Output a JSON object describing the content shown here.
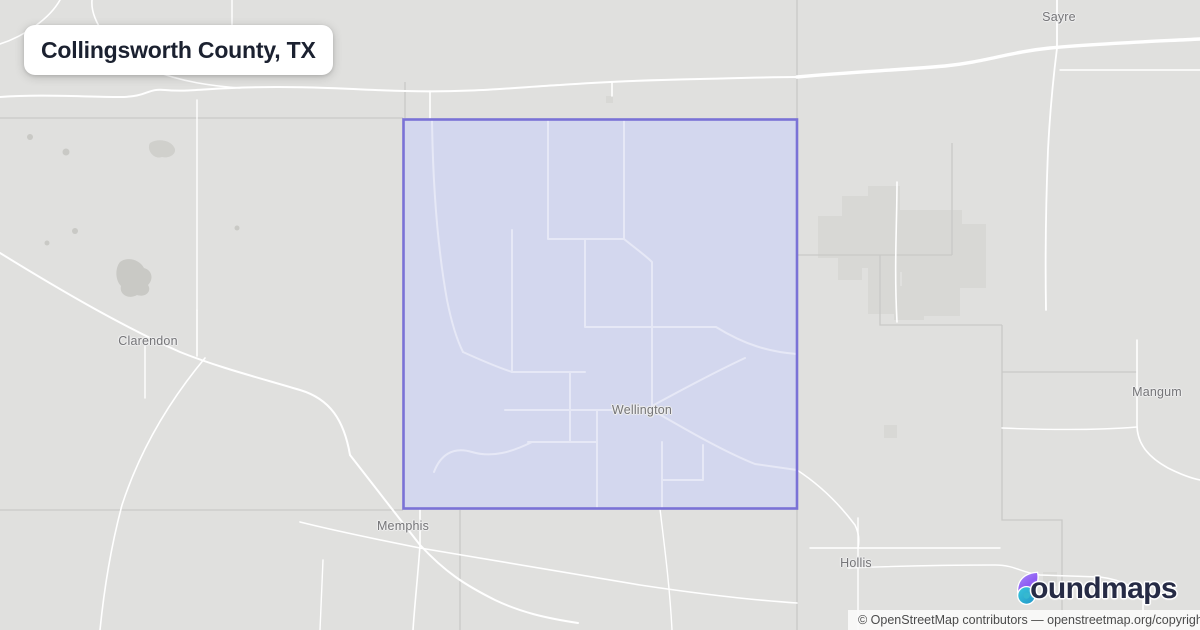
{
  "title_card": {
    "title": "Collingsworth County, TX"
  },
  "highlight": {
    "county": "Collingsworth",
    "fill_color": "#d3d7ee",
    "border_color": "#7a72d6"
  },
  "map_labels": [
    {
      "id": "sayre",
      "text": "Sayre",
      "x": 1059,
      "y": 17
    },
    {
      "id": "clarendon",
      "text": "Clarendon",
      "x": 148,
      "y": 341
    },
    {
      "id": "wellington",
      "text": "Wellington",
      "x": 642,
      "y": 410
    },
    {
      "id": "memphis",
      "text": "Memphis",
      "x": 403,
      "y": 526
    },
    {
      "id": "mangum",
      "text": "Mangum",
      "x": 1157,
      "y": 392
    },
    {
      "id": "hollis",
      "text": "Hollis",
      "x": 856,
      "y": 563
    }
  ],
  "logo": {
    "brand": "boundmaps",
    "wordmark_rest": "oundmaps",
    "icon_purple_light": "#a78bfa",
    "icon_purple_dark": "#7c3aed",
    "icon_teal": "#2fb9cd"
  },
  "attribution": {
    "text": "© OpenStreetMap contributors — openstreetmap.org/copyright"
  }
}
